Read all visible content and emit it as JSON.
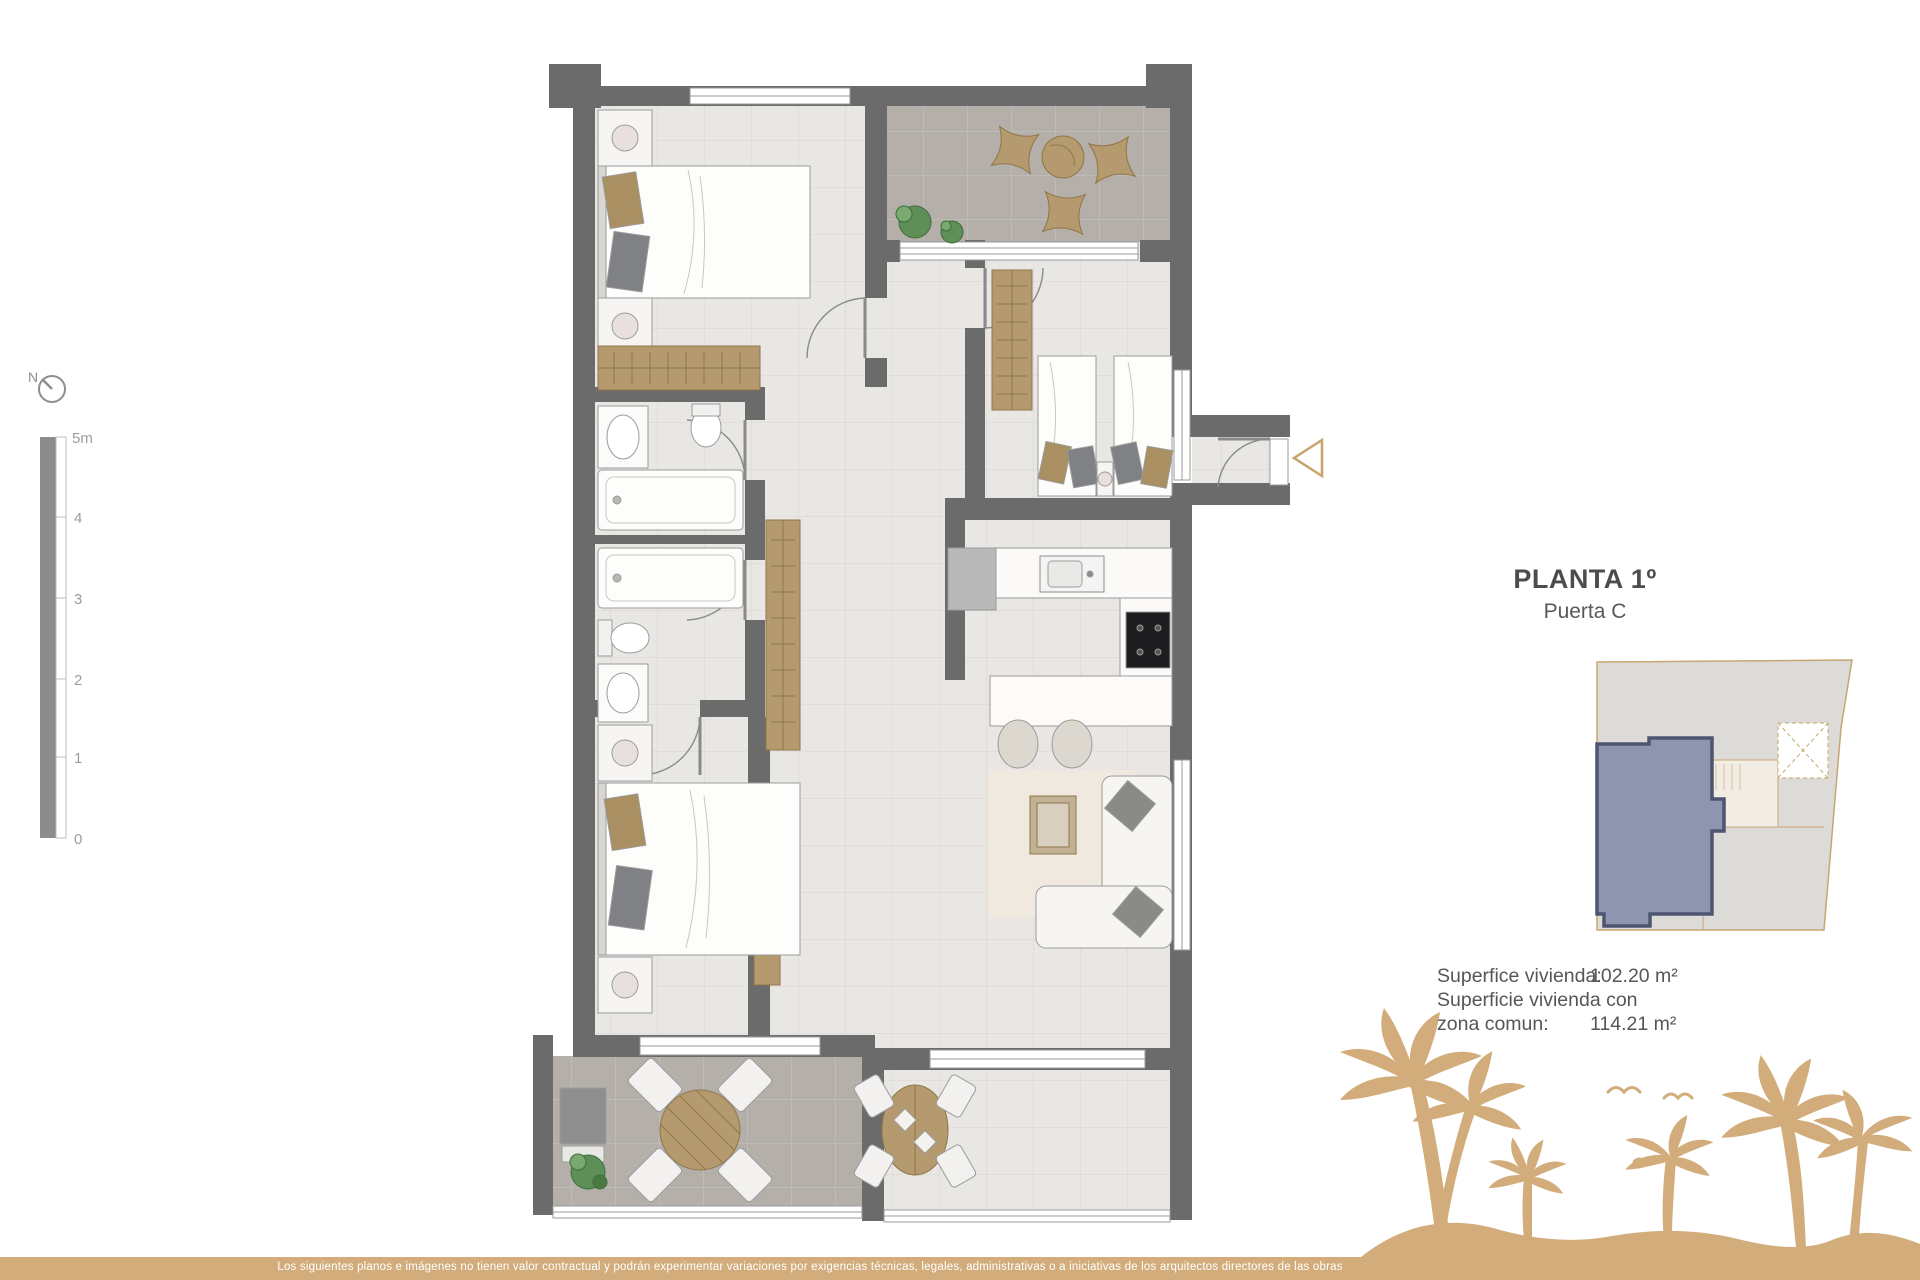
{
  "compass": {
    "label": "N"
  },
  "scale": {
    "ticks": [
      "5m",
      "4",
      "3",
      "2",
      "1",
      "0"
    ]
  },
  "panel": {
    "title": "PLANTA 1º",
    "subtitle": "Puerta C",
    "areas": [
      {
        "label": "Superfice vivienda:",
        "value": "102.20 m²"
      },
      {
        "label": "Superficie vivienda con",
        "value": ""
      },
      {
        "label": "zona comun:",
        "value": "114.21 m²"
      }
    ]
  },
  "footer": {
    "disclaimer": "Los siguientes planos e imágenes no tienen valor contractual y podrán experimentar variaciones por exigencias técnicas, legales, administrativas o a iniciativas de los arquitectos directores de las obras"
  },
  "colors": {
    "wall": "#6b6b6b",
    "interior_floor": "#e9e7e4",
    "terrace_floor": "#b4afa9",
    "wood": "#b49a6e",
    "accent_tan": "#d2ad7b",
    "unit_highlight_fill": "#8e96af",
    "unit_highlight_stroke": "#4e5571",
    "keyplan_fill": "#dcdbd8",
    "keyplan_stroke": "#c6a671",
    "text_gray": "#55565a"
  }
}
